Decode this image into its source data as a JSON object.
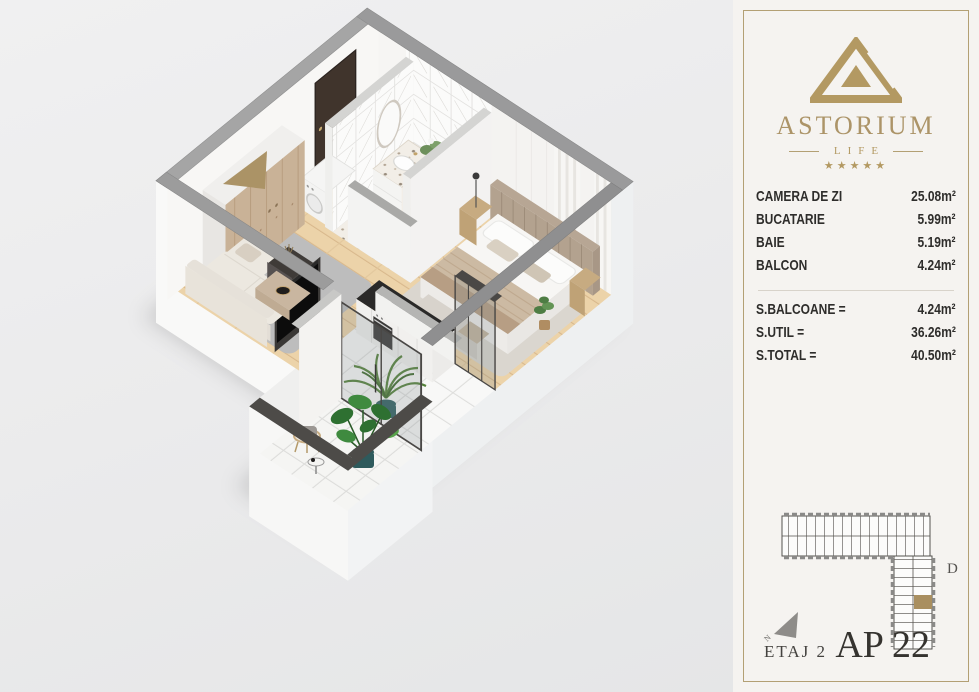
{
  "brand": {
    "name": "ASTORIUM",
    "sub": "LIFE",
    "stars": "★★★★★"
  },
  "panel": {
    "rooms": [
      {
        "label": "CAMERA DE ZI",
        "value": "25.08m²"
      },
      {
        "label": "BUCATARIE",
        "value": "5.99m²"
      },
      {
        "label": "BAIE",
        "value": "5.19m²"
      },
      {
        "label": "BALCON",
        "value": "4.24m²"
      }
    ],
    "totals": [
      {
        "label": "S.BALCOANE =",
        "value": "4.24m²"
      },
      {
        "label": "S.UTIL =",
        "value": "36.26m²"
      },
      {
        "label": "S.TOTAL =",
        "value": "40.50m²"
      }
    ],
    "building_label": "D",
    "compass_letter": "N",
    "floor": "ETAJ 2",
    "apartment": "AP 22"
  },
  "colors": {
    "gold": "#ab9265",
    "panel_bg": "#f5f3f0",
    "text_dark": "#2e2d2b",
    "wall_gray": "#9a9a9b",
    "rail_charcoal": "#4d4b48",
    "wood_floor": "#ecd3a9",
    "highlight_unit": "#a98f60"
  }
}
